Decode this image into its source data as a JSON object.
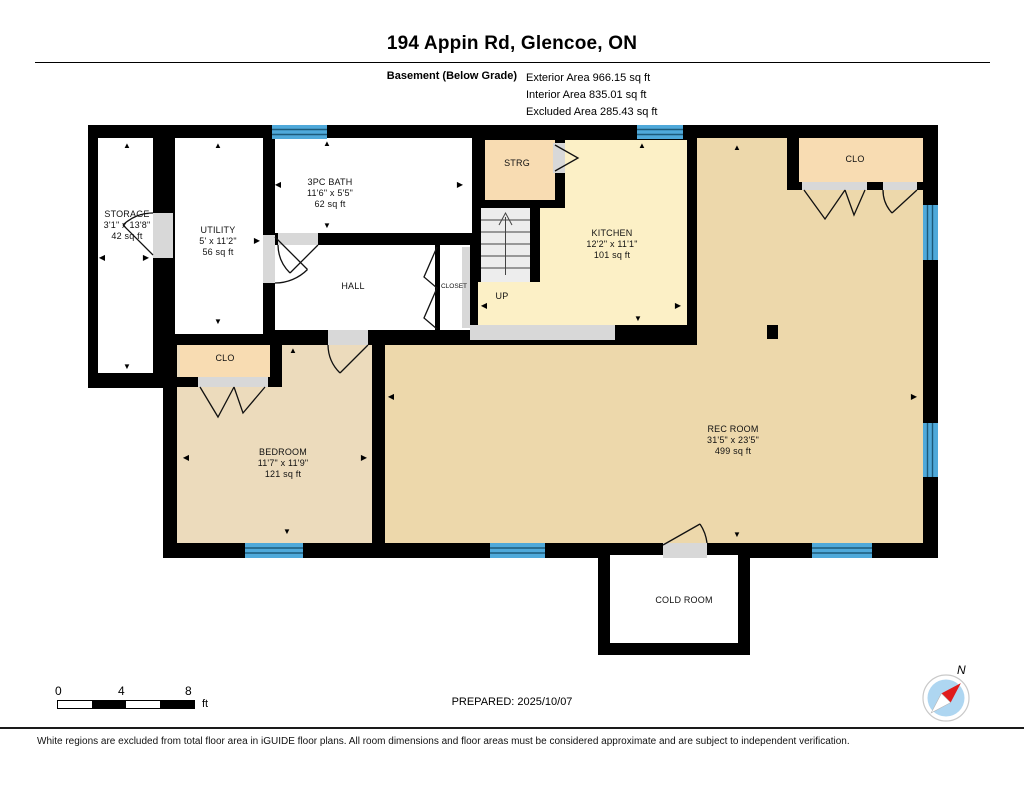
{
  "header": {
    "title": "194 Appin Rd, Glencoe, ON",
    "floor_label": "Basement (Below Grade)",
    "areas": [
      "Exterior Area 966.15 sq ft",
      "Interior Area 835.01 sq ft",
      "Excluded Area 285.43 sq ft"
    ]
  },
  "rooms": {
    "storage": {
      "name": "STORAGE",
      "dims": "3'1\" x 13'8\"",
      "area": "42 sq ft"
    },
    "utility": {
      "name": "UTILITY",
      "dims": "5' x 11'2\"",
      "area": "56 sq ft"
    },
    "bath": {
      "name": "3PC BATH",
      "dims": "11'6\" x 5'5\"",
      "area": "62 sq ft"
    },
    "hall": {
      "name": "HALL"
    },
    "closet": {
      "name": "CLOSET"
    },
    "strg": {
      "name": "STRG"
    },
    "stairs": {
      "up_label": "UP"
    },
    "kitchen": {
      "name": "KITCHEN",
      "dims": "12'2\" x 11'1\"",
      "area": "101 sq ft"
    },
    "clo_right": {
      "name": "CLO"
    },
    "clo_left": {
      "name": "CLO"
    },
    "bedroom": {
      "name": "BEDROOM",
      "dims": "11'7\" x 11'9\"",
      "area": "121 sq ft"
    },
    "rec": {
      "name": "REC ROOM",
      "dims": "31'5\" x 23'5\"",
      "area": "499 sq ft"
    },
    "cold": {
      "name": "COLD ROOM"
    }
  },
  "footer": {
    "scale": {
      "t0": "0",
      "t4": "4",
      "t8": "8",
      "unit": "ft"
    },
    "prepared": "PREPARED: 2025/10/07",
    "disclaimer": "White regions are excluded from total floor area in iGUIDE floor plans. All room dimensions and floor areas must be considered approximate and are subject to independent verification."
  },
  "compass": {
    "label": "N"
  },
  "colors": {
    "wall": "#000000",
    "window_blue": "#4fa9da",
    "window_line": "#1d5a7a",
    "kitchen_fill": "#fcf0c6",
    "closet_fill": "#f8dcb2",
    "rec_fill": "#edd8ab",
    "bedroom_fill": "#ecdbbc",
    "threshold_gray": "#d8d8d8",
    "compass_needle_red": "#e01b1b",
    "compass_face_blue": "#aed6f1"
  }
}
